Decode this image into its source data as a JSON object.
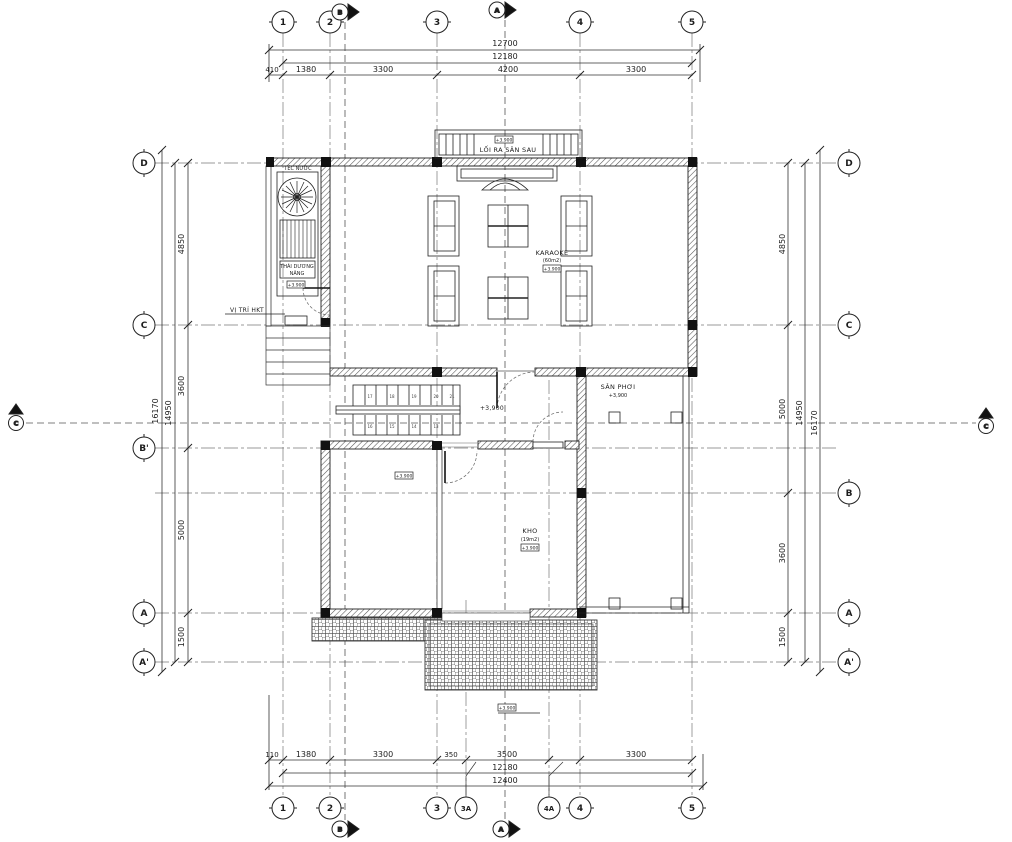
{
  "grid": {
    "top": [
      "1",
      "2",
      "3",
      "4",
      "5"
    ],
    "bottom": [
      "1",
      "2",
      "3",
      "3A",
      "4A",
      "4",
      "5"
    ],
    "left": [
      "D",
      "C",
      "B'",
      "A",
      "A'"
    ],
    "right": [
      "D",
      "C",
      "B",
      "A",
      "A'"
    ]
  },
  "sections": {
    "v1": "B",
    "v2": "A",
    "h": "C"
  },
  "dimensions": {
    "top": {
      "total": "12700",
      "chain": "12180",
      "segments": [
        "410",
        "1380",
        "3300",
        "4200",
        "3300"
      ]
    },
    "bottom": {
      "total": "12400",
      "chain": "12180",
      "segments": [
        "110",
        "1380",
        "3300",
        "350",
        "3500",
        "3300"
      ]
    },
    "left": {
      "total": "16170",
      "chain": "14950",
      "segments": [
        "4850",
        "3600",
        "5000",
        "1500"
      ]
    },
    "right": {
      "total": "16170",
      "chain": "14950",
      "segments": [
        "4850",
        "5000",
        "3600",
        "1500"
      ]
    }
  },
  "labels": {
    "exit_rear": "LỐI RA SÂN SAU",
    "water_tank": "TÉC NƯỚC",
    "solar_line1": "THÁI DƯƠNG",
    "solar_line2": "NĂNG",
    "hkt_position": "VỊ TRÍ HKT",
    "karaoke_name": "KARAOKE",
    "karaoke_area": "(60m2)",
    "san_phoi_name": "SÂN PHƠI",
    "san_phoi_level": "+3,900",
    "stair_level": "+3,900",
    "kho_name": "KHO",
    "kho_area": "(19m2)",
    "level_tag": "+3.900"
  },
  "stairs": {
    "upper": [
      "17",
      "18",
      "19",
      "20",
      "21"
    ],
    "lower": [
      "16",
      "15",
      "14",
      "13"
    ]
  }
}
